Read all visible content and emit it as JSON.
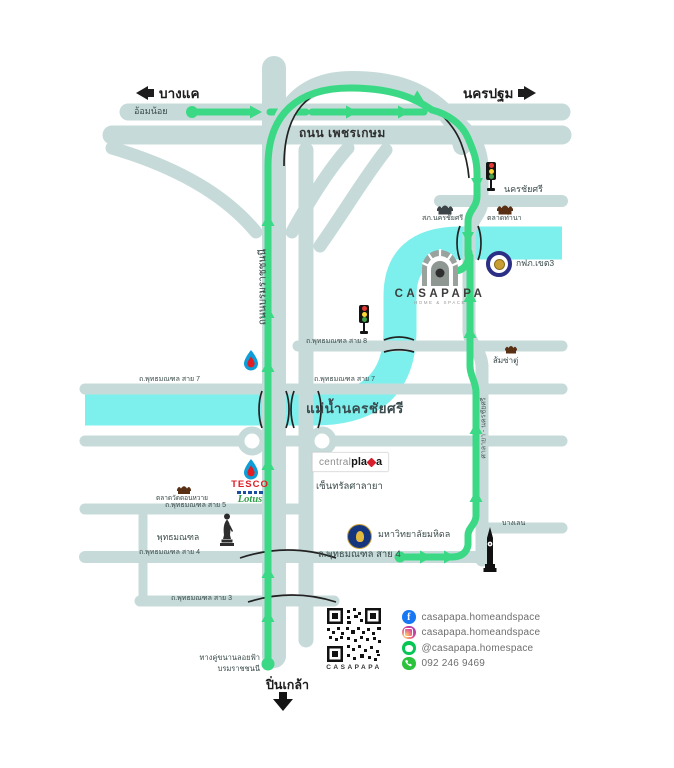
{
  "destinations": {
    "bang_khae": "บางแค",
    "nakhon_pathom": "นครปฐม",
    "pin_klao": "ปิ่นเกล้า"
  },
  "roads": {
    "om_noi": "อ้อมน้อย",
    "phetkasem": "ถนน เพชรเกษม",
    "nakhon_chai_si": "นครชัยศรี",
    "borommaratchachonnani": "ถนนบรมราชชนนี",
    "salaya_nakhonchaisi": "ศาลายา - นครชัยศรี",
    "bang_len": "บางเลน",
    "sai8": "ถ.พุทธมณฑล สาย 8",
    "sai7": "ถ.พุทธมณฑล สาย 7",
    "sai5": "ถ.พุทธมณฑล สาย 5",
    "sai4": "ถ.พุทธมณฑล สาย 4",
    "sai3": "ถ.พุทธมณฑล สาย 3"
  },
  "river": {
    "name": "แม่น้ำนครชัยศรี"
  },
  "places": {
    "police": "สภ.นครชัยศรี",
    "thana_market": "ตลาดท่านา",
    "pea": "กฟภ.เขต3",
    "som_sa": "ส้มซ่าตู่",
    "don_wai_market": "ตลาดวัดดอนหวาย",
    "phutthamonthon": "พุทธมณฑล",
    "mahidol": "มหาวิทยาลัยมหิดล"
  },
  "casapapa": {
    "name": "CASAPAPA",
    "tagline": "home & space"
  },
  "tesco": {
    "line1": "TESCO",
    "line2": "Lotus"
  },
  "centralplaza": {
    "part1": "central",
    "part2": "pla",
    "part3": "a",
    "thai": "เซ็นทรัลศาลายา"
  },
  "bottom": {
    "elevated_line1": "ทางคู่ขนานลอยฟ้า",
    "elevated_line2": "บรมราชชนนี"
  },
  "contact": {
    "qr_caption": "CASAPAPA",
    "facebook": "casapapa.homeandspace",
    "instagram": "casapapa.homeandspace",
    "line": "@casapapa.homespace",
    "phone": "092 246 9469"
  }
}
